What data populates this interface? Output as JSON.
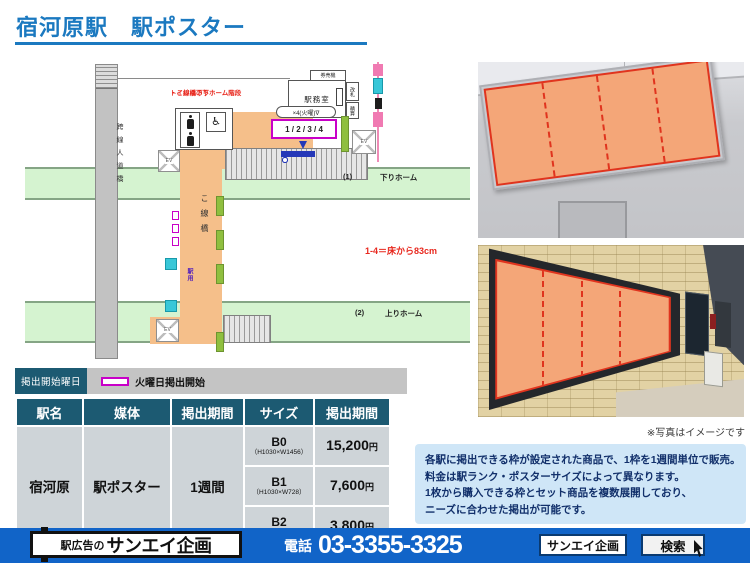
{
  "header": {
    "title": "宿河原駅　駅ポスター"
  },
  "diagram": {
    "overpass": "跨線人道橋",
    "toilet_note1": "トイレは下りホーム階段",
    "toilet_note2": "・こ線橋の下",
    "office": "駅務室",
    "ticket_machines": "券売機",
    "gate_box": "改札",
    "fare_box": "精算",
    "frame_count": "×4(火曜)∇",
    "frame_numbers": "1 / 2 / 3 / 4",
    "down_no": "(1)",
    "down_name": "下りホーム",
    "up_no": "(2)",
    "up_name": "上りホーム",
    "height_note": "1-4＝床から83cm",
    "bridge": "こ線橋",
    "station_use": "駅用",
    "ev": "EV",
    "accessible_icon": "♿"
  },
  "legend": {
    "title": "掲出開始曜日",
    "item": "火曜日掲出開始"
  },
  "table": {
    "headers": [
      "駅名",
      "媒体",
      "掲出期間",
      "サイズ",
      "掲出期間"
    ],
    "station": "宿河原",
    "media": "駅ポスター",
    "period": "1週間",
    "rows": [
      {
        "size": "B0",
        "dims": "（H1030×W1456）",
        "price": "15,200",
        "unit": "円"
      },
      {
        "size": "B1",
        "dims": "（H1030×W728）",
        "price": "7,600",
        "unit": "円"
      },
      {
        "size": "B2",
        "dims": "（H728×W515）",
        "price": "3,800",
        "unit": "円"
      }
    ]
  },
  "photos": {
    "caption": "※写真はイメージです"
  },
  "info": {
    "line1": "各駅に掲出できる枠が設定された商品で、1枠を1週間単位で販売。",
    "line2": "料金は駅ランク・ポスターサイズによって異なります。",
    "line3": "1枚から購入できる枠とセット商品を複数展開しており、",
    "line4": "ニーズに合わせた掲出が可能です。"
  },
  "footer": {
    "brand_prefix": "駅広告の",
    "brand": "サンエイ企画",
    "phone_label": "電話",
    "phone": "03-3355-3325",
    "search_value": "サンエイ企画",
    "search_label": "検索"
  },
  "colors": {
    "accent_blue": "#1b79c0",
    "footer_blue": "#1164c8",
    "table_header_teal": "#1c5a72",
    "highlight_orange": "#f4a678",
    "marker_magenta": "#c800c8",
    "platform_green": "#d5f3d0"
  }
}
